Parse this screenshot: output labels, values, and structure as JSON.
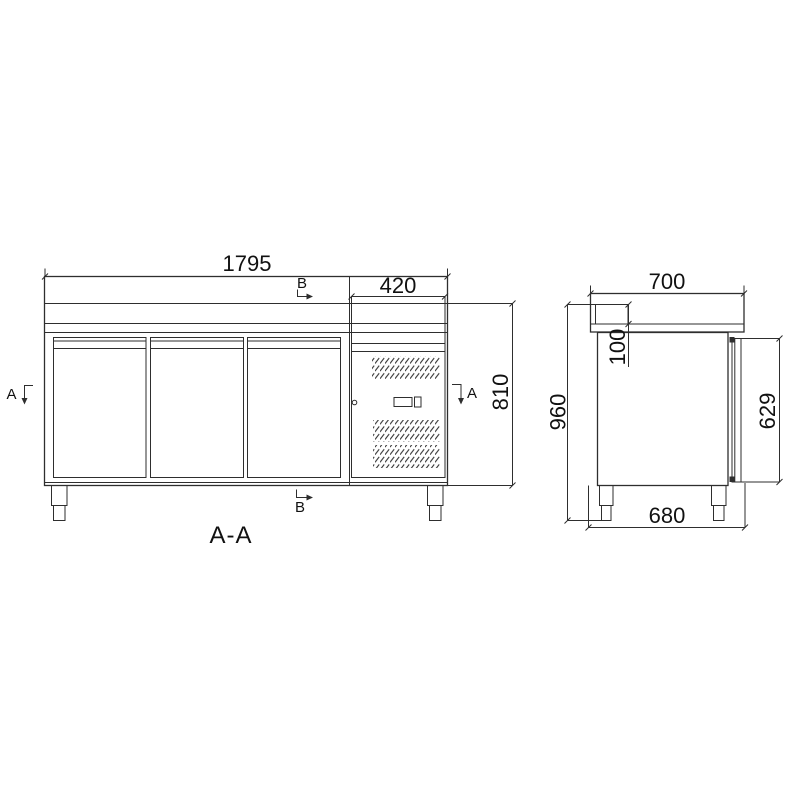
{
  "drawing": {
    "section_label": "A-A",
    "markers": {
      "a": "A",
      "b": "B"
    },
    "front_view": {
      "overall_width": "1795",
      "engine_section_width": "420",
      "body_height": "810"
    },
    "side_view": {
      "overall_depth": "700",
      "overall_height": "960",
      "backsplash_height": "100",
      "door_height": "629",
      "base_depth": "680"
    },
    "colors": {
      "line": "#2e2e2e",
      "text": "#111111",
      "background": "#ffffff"
    }
  }
}
